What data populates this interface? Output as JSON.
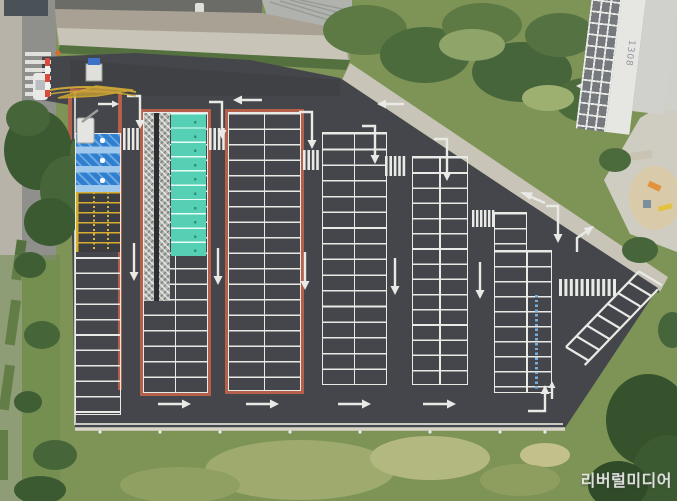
{
  "meta": {
    "type": "aerial-photo",
    "subject": "Top-down drone view of a newly paved outdoor parking lot beside an apartment complex"
  },
  "watermark": {
    "text": "리버럴미디어"
  },
  "building": {
    "label": "1308"
  },
  "colors": {
    "asphalt": "#44464b",
    "asphalt_dark": "#3a3c40",
    "line": "#e9eae6",
    "curb": "#b5604a",
    "teal": "#56d0b4",
    "blue": "#2e7fd0",
    "hatch_blue": "#9fc8ec",
    "yellow": "#d8ae2e",
    "grass": "#7d9456",
    "grass_light": "#a3ad72",
    "tree": "#3c5a31",
    "tree_light": "#4c6b3c",
    "path": "#c8c4b7",
    "road": "#8f8f8b",
    "sidewalk": "#b7b3a8",
    "building_win": "#75797d",
    "building_wall": "#e6e7e3",
    "sand": "#d9cbaa",
    "equipment": "#e0923f",
    "booth_blue": "#3d72c8",
    "cone": "#d86a2a"
  },
  "lot": {
    "sections": [
      {
        "id": "left-column",
        "stalls": 11,
        "marking": "white"
      },
      {
        "id": "disabled-zone",
        "stalls": 3,
        "marking": "blue with hatched separators",
        "icon": "wheelchair-icon"
      },
      {
        "id": "yellow-zone",
        "stalls": 6,
        "marking": "yellow border and yellow text"
      },
      {
        "id": "walkway-ev-column",
        "ev_stalls": 10,
        "white_stalls": 9,
        "marking": "teal stalls + hatched pedestrian walkway",
        "curb": "red-orange"
      },
      {
        "id": "column-3",
        "stalls": 34,
        "marking": "white",
        "curb": "red-orange"
      },
      {
        "id": "column-4",
        "stalls": 32,
        "marking": "white"
      },
      {
        "id": "column-5",
        "stalls": 30,
        "marking": "white"
      },
      {
        "id": "column-6",
        "stalls": 21,
        "marking": "white with blue side text"
      },
      {
        "id": "angled-row",
        "stalls": 7,
        "marking": "white, angled at north-east corner"
      }
    ],
    "road_markings": [
      "left arrows",
      "right arrows",
      "down arrows",
      "bent turn arrows",
      "zebra crossings",
      "yellow entrance guide lines"
    ]
  }
}
